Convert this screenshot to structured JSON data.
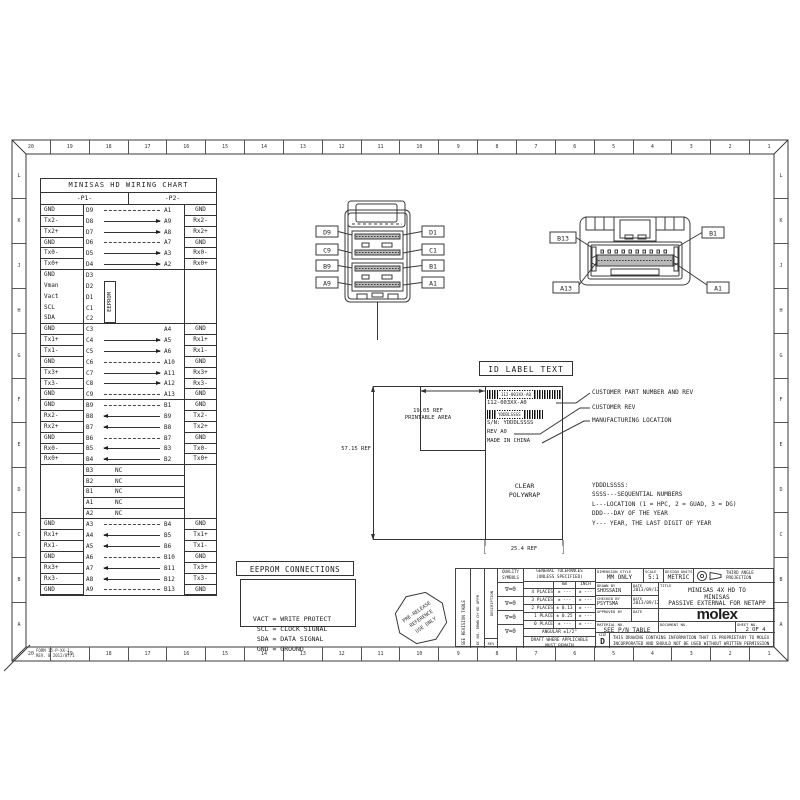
{
  "sheet": {
    "zone_numbers": [
      "20",
      "19",
      "18",
      "17",
      "16",
      "15",
      "14",
      "13",
      "12",
      "11",
      "10",
      "9",
      "8",
      "7",
      "6",
      "5",
      "4",
      "3",
      "2",
      "1"
    ],
    "zone_letters": [
      "L",
      "K",
      "J",
      "H",
      "G",
      "F",
      "E",
      "D",
      "C",
      "B",
      "A"
    ],
    "footer_line1": "FORM 15-P-XX-1",
    "footer_line2": "REV. 0  2012/07/1"
  },
  "wiring_chart": {
    "title": "MINISAS HD WIRING CHART",
    "p1_header": "-P1-",
    "p2_header": "-P2-",
    "eeprom_label": "EEPROM",
    "rows": [
      {
        "l": "GND",
        "a": "D9",
        "b": "A1",
        "r": "GND",
        "cls": "gnd"
      },
      {
        "l": "Tx2-",
        "a": "D8",
        "b": "A9",
        "r": "Rx2-",
        "cls": "tx"
      },
      {
        "l": "Tx2+",
        "a": "D7",
        "b": "A8",
        "r": "Rx2+",
        "cls": "tx"
      },
      {
        "l": "GND",
        "a": "D6",
        "b": "A7",
        "r": "GND",
        "cls": "gnd"
      },
      {
        "l": "Tx0-",
        "a": "D5",
        "b": "A3",
        "r": "Rx0-",
        "cls": "tx"
      },
      {
        "l": "Tx0+",
        "a": "D4",
        "b": "A2",
        "r": "Rx0+",
        "cls": "tx sep"
      },
      {
        "l": "GND",
        "a": "D3",
        "b": "",
        "r": "",
        "cls": "eeprom open"
      },
      {
        "l": "Vman",
        "a": "D2",
        "b": "",
        "r": "",
        "cls": "eeprom open"
      },
      {
        "l": "Vact",
        "a": "D1",
        "b": "",
        "r": "",
        "cls": "eeprom open"
      },
      {
        "l": "SCL",
        "a": "C1",
        "b": "",
        "r": "",
        "cls": "eeprom open"
      },
      {
        "l": "SDA",
        "a": "C2",
        "b": "",
        "r": "",
        "cls": "eeprom sep"
      },
      {
        "l": "GND",
        "a": "C3",
        "b": "A4",
        "r": "GND",
        "cls": "plain"
      },
      {
        "l": "Tx1+",
        "a": "C4",
        "b": "A5",
        "r": "Rx1+",
        "cls": "tx"
      },
      {
        "l": "Tx1-",
        "a": "C5",
        "b": "A6",
        "r": "Rx1-",
        "cls": "tx"
      },
      {
        "l": "GND",
        "a": "C6",
        "b": "A10",
        "r": "GND",
        "cls": "gnd"
      },
      {
        "l": "Tx3+",
        "a": "C7",
        "b": "A11",
        "r": "Rx3+",
        "cls": "tx"
      },
      {
        "l": "Tx3-",
        "a": "C8",
        "b": "A12",
        "r": "Rx3-",
        "cls": "tx"
      },
      {
        "l": "GND",
        "a": "C9",
        "b": "A13",
        "r": "GND",
        "cls": "gnd sep"
      },
      {
        "l": "GND",
        "a": "B9",
        "b": "B1",
        "r": "GND",
        "cls": "gnd"
      },
      {
        "l": "Rx2-",
        "a": "B8",
        "b": "B9",
        "r": "Tx2-",
        "cls": "rx"
      },
      {
        "l": "Rx2+",
        "a": "B7",
        "b": "B8",
        "r": "Tx2+",
        "cls": "rx"
      },
      {
        "l": "GND",
        "a": "B6",
        "b": "B7",
        "r": "GND",
        "cls": "gnd"
      },
      {
        "l": "Rx0-",
        "a": "B5",
        "b": "B3",
        "r": "Tx0-",
        "cls": "rx"
      },
      {
        "l": "Rx0+",
        "a": "B4",
        "b": "B2",
        "r": "Tx0+",
        "cls": "rx sep"
      },
      {
        "l": "",
        "a": "B3",
        "b": "NC",
        "r": "",
        "cls": "nc"
      },
      {
        "l": "",
        "a": "B2",
        "b": "NC",
        "r": "",
        "cls": "nc"
      },
      {
        "l": "",
        "a": "B1",
        "b": "NC",
        "r": "",
        "cls": "nc"
      },
      {
        "l": "",
        "a": "A1",
        "b": "NC",
        "r": "",
        "cls": "nc"
      },
      {
        "l": "",
        "a": "A2",
        "b": "NC",
        "r": "",
        "cls": "nc sep"
      },
      {
        "l": "GND",
        "a": "A3",
        "b": "B4",
        "r": "GND",
        "cls": "gnd"
      },
      {
        "l": "Rx1+",
        "a": "A4",
        "b": "B5",
        "r": "Tx1+",
        "cls": "rx"
      },
      {
        "l": "Rx1-",
        "a": "A5",
        "b": "B6",
        "r": "Tx1-",
        "cls": "rx"
      },
      {
        "l": "GND",
        "a": "A6",
        "b": "B10",
        "r": "GND",
        "cls": "gnd"
      },
      {
        "l": "Rx3+",
        "a": "A7",
        "b": "B11",
        "r": "Tx3+",
        "cls": "rx"
      },
      {
        "l": "Rx3-",
        "a": "A8",
        "b": "B12",
        "r": "Tx3-",
        "cls": "rx"
      },
      {
        "l": "GND",
        "a": "A9",
        "b": "B13",
        "r": "GND",
        "cls": "gnd"
      }
    ]
  },
  "connector_p1": {
    "labels_left": [
      "D9",
      "C9",
      "B9",
      "A9"
    ],
    "labels_right": [
      "D1",
      "C1",
      "B1",
      "A1"
    ]
  },
  "connector_p2": {
    "label_b13": "B13",
    "label_b1": "B1",
    "label_a13": "A13",
    "label_a1": "A1"
  },
  "id_label": {
    "title": "ID LABEL TEXT",
    "part_number": "112-003XX-A0",
    "barcode2_text": "YDDDLSSSS",
    "sn": "S/N: YDDDLSSSS",
    "rev": "REV A0",
    "made_in": "MADE IN CHINA",
    "dim_printable_1": "19.05 REF",
    "dim_printable_2": "PRINTABLE AREA",
    "dim_height": "57.15 REF",
    "dim_width": "25.4 REF",
    "polywrap_1": "CLEAR",
    "polywrap_2": "POLYWRAP",
    "annotations": [
      "CUSTOMER PART NUMBER AND REV",
      "CUSTOMER REV",
      "MANUFACTURING LOCATION"
    ],
    "legend": [
      "YDDDLSSSS:",
      "SSSS---SEQUENTIAL NUMBERS",
      "L---LOCATION (1 = HPC, 2 = GUAD, 3 = DG)",
      "DDD---DAY OF THE YEAR",
      "Y--- YEAR, THE LAST DIGIT OF YEAR"
    ]
  },
  "eeprom_connections": {
    "title": "EEPROM CONNECTIONS",
    "lines": [
      " VACT = WRITE PROTECT",
      "  SCL = CLOCK SIGNAL",
      "  SDA = DATA SIGNAL",
      "  GND = GROUND"
    ]
  },
  "stamp": {
    "line1": "PRE-RELEASE",
    "line2": "REFERENCE",
    "line3": "USE ONLY"
  },
  "title_block": {
    "see_revision": "SEE REVISION TABLE",
    "rev_cols": "EC NO.   DRWN   CH'KD   APPR",
    "description": "DESCRIPTION",
    "rev": "REV",
    "quality_1": "QUALITY",
    "quality_2": "SYMBOLS",
    "quality_symbol": "∇=0",
    "tol_header_1": "GENERAL TOLERANCES",
    "tol_header_2": "(UNLESS SPECIFIED)",
    "col_mm": "mm",
    "col_inch": "INCH",
    "tol_rows": [
      {
        "label": "4 PLACES",
        "mm": "± ---",
        "inch": "± ---"
      },
      {
        "label": "3 PLACES",
        "mm": "± ---",
        "inch": "± ---"
      },
      {
        "label": "2 PLACES",
        "mm": "± 0.13",
        "inch": "± ---"
      },
      {
        "label": "1 PLACE",
        "mm": "± 0.25",
        "inch": "± ---"
      },
      {
        "label": "0 PLACE",
        "mm": "± ---",
        "inch": "± ---"
      }
    ],
    "angular": "ANGULAR ±1/2°",
    "draft_1": "DRAFT WHERE APPLICABLE",
    "draft_2": "MUST REMAIN",
    "draft_3": "WITHIN DIMENSIONS",
    "dim_style_label": "DIMENSION STYLE",
    "dim_style_value": "MM ONLY",
    "scale_label": "SCALE",
    "scale_value": "5:1",
    "units_label": "DESIGN UNITS",
    "units_value": "METRIC",
    "projection_1": "THIRD ANGLE",
    "projection_2": "PROJECTION",
    "drawn_label": "DRAWN BY",
    "drawn_name": "SHOSSAIN",
    "checked_label": "CHECKED BY",
    "checked_name": "PSYTSMA",
    "approved_label": "APPROVED BY",
    "date_label": "DATE",
    "drawn_date": "2013/09/12",
    "checked_date": "2013/09/12",
    "title_label": "TITLE",
    "title_line_1": "MINISAS 4X HD TO",
    "title_line_2": "MINISAS",
    "title_line_3": "PASSIVE EXTERNAL FOR NETAPP",
    "logo": "molex",
    "material_label": "MATERIAL NO.",
    "material_value": "SEE P/N TABLE",
    "document_label": "DOCUMENT NO.",
    "sheet_label": "SHEET NO.",
    "sheet_value": "2 OF 4",
    "size_label": "SIZE",
    "size_value": "D",
    "prop_1": "THIS DRAWING CONTAINS INFORMATION THAT IS PROPRIETARY TO MOLEX",
    "prop_2": "INCORPORATED AND SHOULD NOT BE USED WITHOUT WRITTEN PERMISSION"
  }
}
